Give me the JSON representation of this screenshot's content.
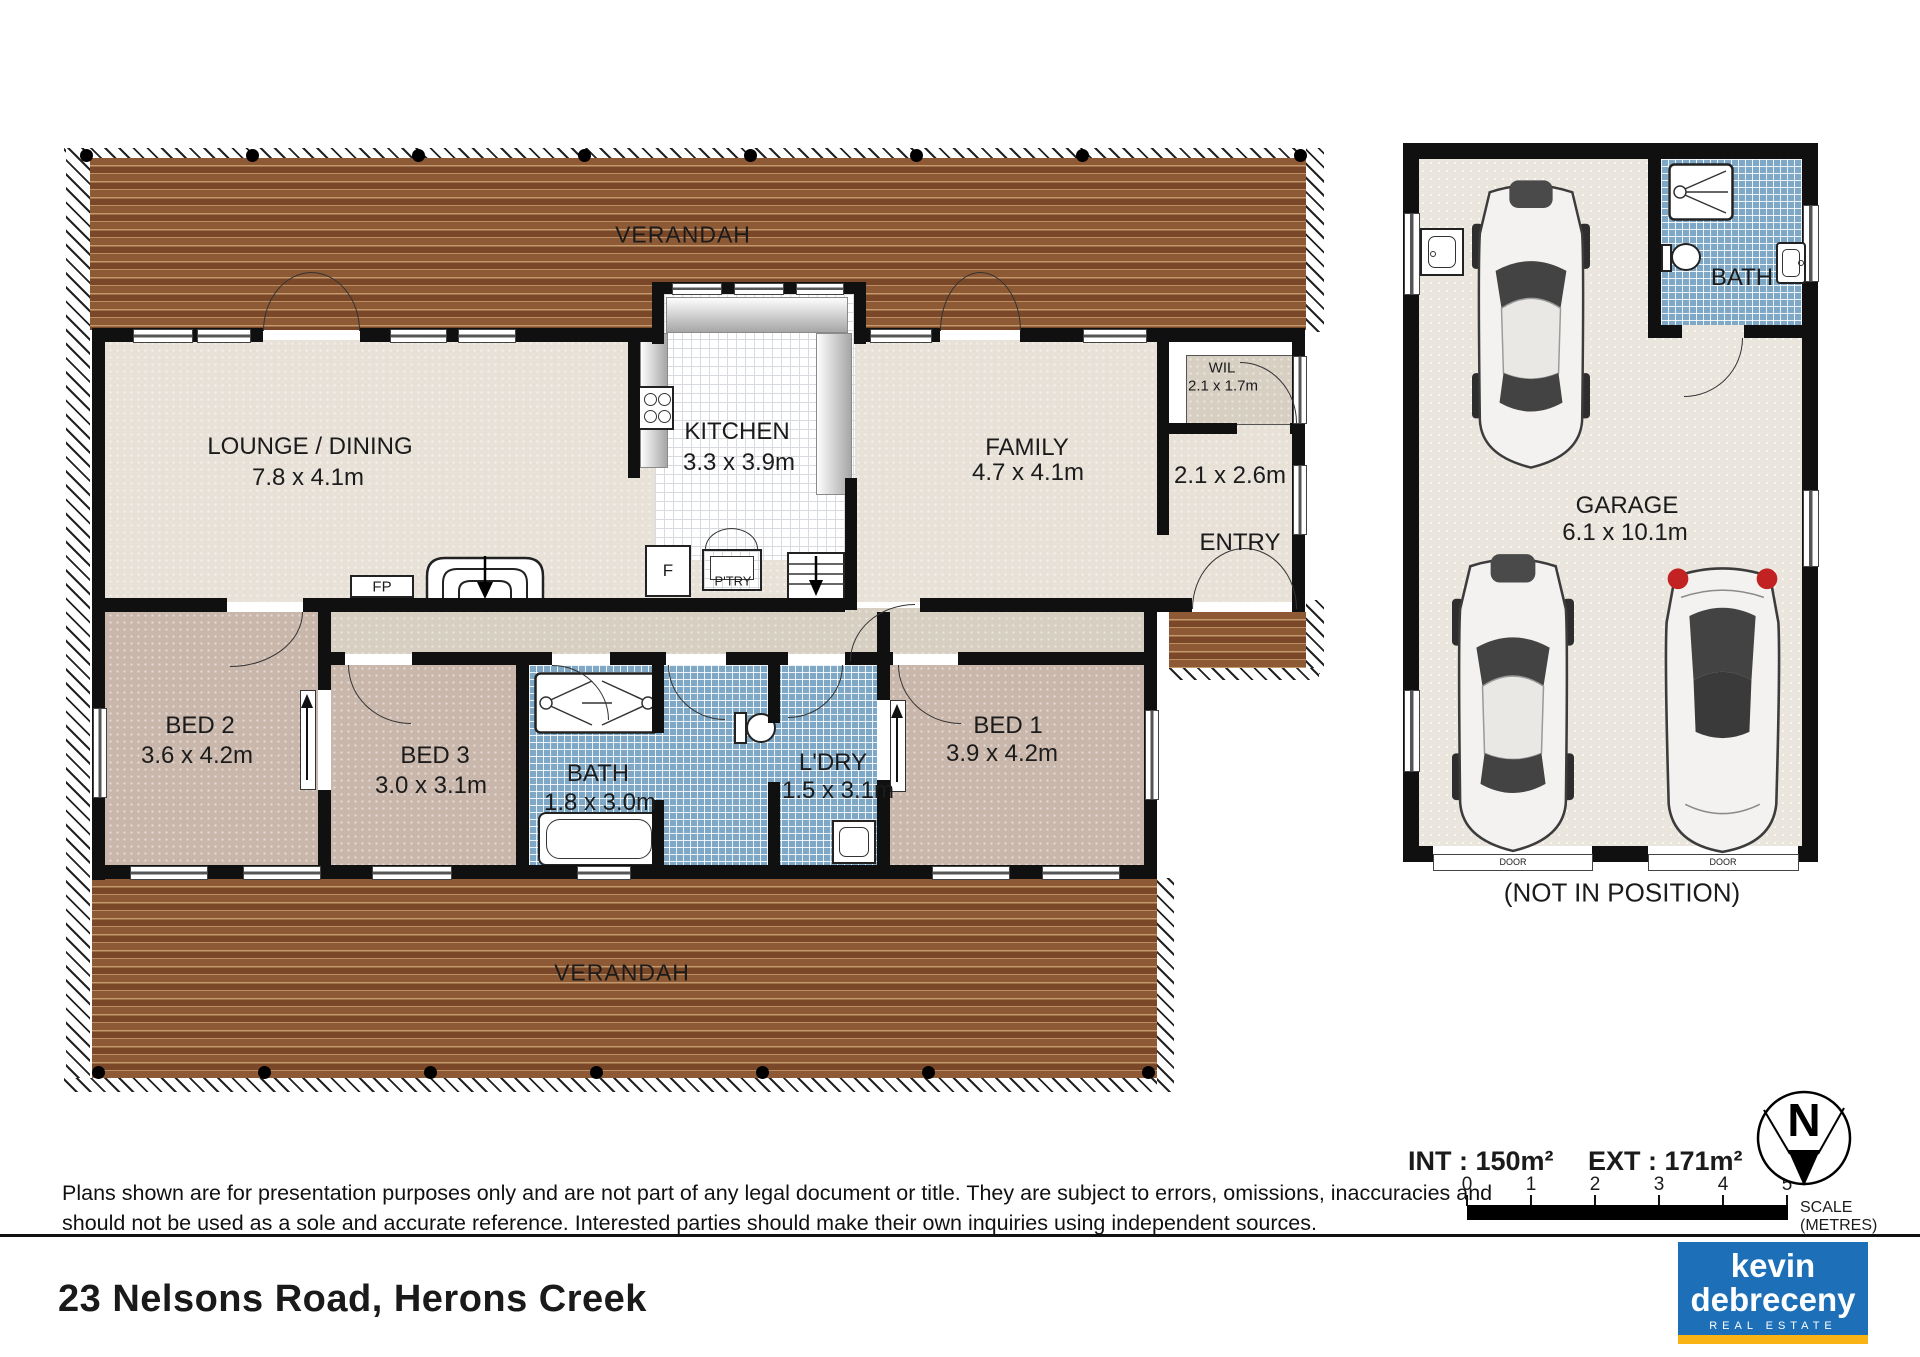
{
  "plan": {
    "verandah_label": "VERANDAH",
    "rooms": {
      "lounge": {
        "label": "LOUNGE / DINING",
        "dims": "7.8 x 4.1m"
      },
      "kitchen": {
        "label": "KITCHEN",
        "dims": "3.3 x 3.9m"
      },
      "family": {
        "label": "FAMILY",
        "dims": "4.7 x 4.1m"
      },
      "wil": {
        "label": "WIL",
        "dims": "2.1 x 1.7m"
      },
      "entry": {
        "label": "ENTRY",
        "dims": "2.1 x 2.6m"
      },
      "bed1": {
        "label": "BED 1",
        "dims": "3.9 x 4.2m"
      },
      "bed2": {
        "label": "BED 2",
        "dims": "3.6 x 4.2m"
      },
      "bed3": {
        "label": "BED 3",
        "dims": "3.0 x 3.1m"
      },
      "bath": {
        "label": "BATH",
        "dims": "1.8 x 3.0m"
      },
      "laundry": {
        "label": "L'DRY",
        "dims": "1.5 x 3.1m"
      },
      "garage": {
        "label": "GARAGE",
        "dims": "6.1 x 10.1m"
      },
      "garage_bath": {
        "label": "BATH"
      }
    },
    "fixtures": {
      "fireplace": "FP",
      "fridge": "F",
      "pantry": "P'TRY",
      "garage_door": "DOOR"
    },
    "garage_note": "(NOT IN POSITION)"
  },
  "legend": {
    "int_area": "INT : 150m²",
    "ext_area": "EXT : 171m²",
    "scale_ticks": [
      "0",
      "1",
      "2",
      "3",
      "4",
      "5"
    ],
    "scale_label": "SCALE (METRES)",
    "north": "N"
  },
  "footer": {
    "disclaimer_line1": "Plans shown are for presentation purposes only and are not part of any legal document or title. They are subject to errors, omissions, inaccuracies and",
    "disclaimer_line2": "should not be used as a sole and accurate reference. Interested parties should make their own inquiries using independent sources.",
    "address": "23 Nelsons Road, Herons Creek",
    "logo": {
      "line1": "kevin",
      "line2": "debreceny",
      "line3": "REAL ESTATE"
    }
  },
  "colors": {
    "deck_brown": "#8d5a35",
    "tile_blue": "#7ea8c5",
    "logo_blue": "#1d70b7",
    "logo_yellow": "#f9b315"
  }
}
